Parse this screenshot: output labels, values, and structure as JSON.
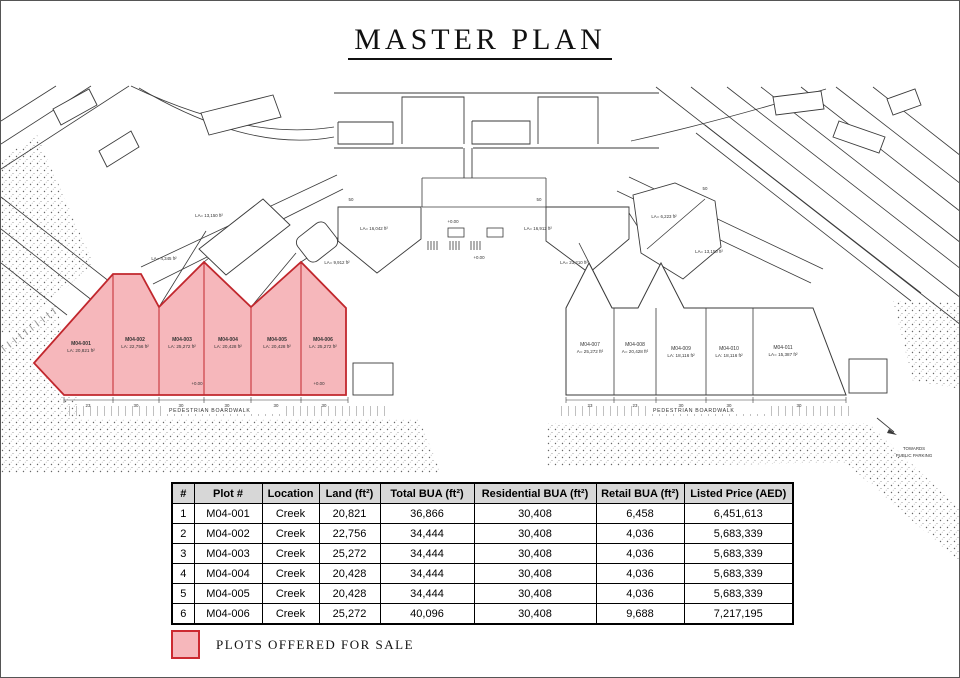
{
  "title": "MASTER PLAN",
  "plan": {
    "pink_plots": [
      {
        "name": "M04-001",
        "area": "LA: 20,821 ft²"
      },
      {
        "name": "M04-002",
        "area": "LA: 22,756 ft²"
      },
      {
        "name": "M04-003",
        "area": "LA: 25,272 ft²"
      },
      {
        "name": "M04-004",
        "area": "LA: 20,428 ft²"
      },
      {
        "name": "M04-005",
        "area": "LA: 20,428 ft²"
      },
      {
        "name": "M04-006",
        "area": "LA: 25,272 ft²"
      }
    ],
    "right_plots": [
      {
        "name": "M04-007",
        "area": "A= 25,272 ft²"
      },
      {
        "name": "M04-008",
        "area": "A= 20,428 ft²"
      },
      {
        "name": "M04-009",
        "area": "LA: 18,116 ft²"
      },
      {
        "name": "M04-010",
        "area": "LA: 18,116 ft²"
      },
      {
        "name": "M04-011",
        "area": "LA= 15,387 ft²"
      }
    ],
    "area_labels": [
      "LA= 4,345 ft²",
      "LA= 13,150 ft²",
      "LA= 9,912 ft²",
      "LA= 16,042 ft²",
      "LA= 16,912 ft²",
      "LA= 23,210 ft²",
      "LA= 6,223 ft²",
      "LA= 13,150 ft²"
    ],
    "boardwalk_label": "PEDESTRIAN BOARDWALK",
    "parking_line1": "TOWARDS",
    "parking_line2": "PUBLIC PARKING",
    "dims_left": [
      "23",
      "30",
      "30",
      "30",
      "30",
      "30"
    ],
    "dims_right": [
      "23",
      "23",
      "30",
      "30",
      "30"
    ],
    "dims_top": [
      "50",
      "50",
      "50"
    ],
    "spot_levels": [
      "+0.00",
      "+0.00",
      "+0.00",
      "+0.00"
    ]
  },
  "table": {
    "headers": [
      "#",
      "Plot #",
      "Location",
      "Land (ft²)",
      "Total BUA (ft²)",
      "Residential BUA (ft²)",
      "Retail BUA (ft²)",
      "Listed Price (AED)"
    ],
    "rows": [
      [
        "1",
        "M04-001",
        "Creek",
        "20,821",
        "36,866",
        "30,408",
        "6,458",
        "6,451,613"
      ],
      [
        "2",
        "M04-002",
        "Creek",
        "22,756",
        "34,444",
        "30,408",
        "4,036",
        "5,683,339"
      ],
      [
        "3",
        "M04-003",
        "Creek",
        "25,272",
        "34,444",
        "30,408",
        "4,036",
        "5,683,339"
      ],
      [
        "4",
        "M04-004",
        "Creek",
        "20,428",
        "34,444",
        "30,408",
        "4,036",
        "5,683,339"
      ],
      [
        "5",
        "M04-005",
        "Creek",
        "20,428",
        "34,444",
        "30,408",
        "4,036",
        "5,683,339"
      ],
      [
        "6",
        "M04-006",
        "Creek",
        "25,272",
        "40,096",
        "30,408",
        "9,688",
        "7,217,195"
      ]
    ]
  },
  "legend": {
    "label": "PLOTS OFFERED FOR SALE"
  },
  "colors": {
    "plot_fill": "#f6b7bb",
    "plot_stroke": "#c1272d",
    "line": "#3a3a3a",
    "header_bg": "#d7d7d7"
  }
}
